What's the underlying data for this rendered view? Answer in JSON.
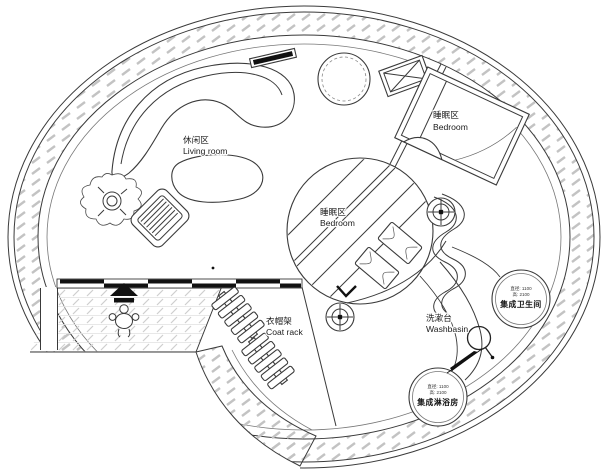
{
  "labels": {
    "living_room": {
      "zh": "休闲区",
      "en": "Living room"
    },
    "bedroom_upper": {
      "zh": "睡眠区",
      "en": "Bedroom"
    },
    "bedroom_center": {
      "zh": "睡眠区",
      "en": "Bedroom"
    },
    "coat_rack": {
      "zh": "衣帽架",
      "en": "Coat rack"
    },
    "washbasin": {
      "zh": "洗漱台",
      "en": "Washbasin"
    }
  },
  "pods": {
    "bathroom": {
      "dims": [
        "直径: 1100",
        "高: 2100"
      ],
      "name": "集成卫生间"
    },
    "shower": {
      "dims": [
        "直径: 1100",
        "高: 2100"
      ],
      "name": "集成淋浴房"
    }
  },
  "symbols": {
    "crosshair": "crosshair-target",
    "plant": "potted-plant",
    "person": "person-entering",
    "entry_arrow": "up-arrow",
    "round_table": "round-table",
    "crossed_box": "crossed-rectangle",
    "drain": "drain-loop",
    "door_wall": "sliding-door-wall"
  },
  "colors": {
    "line": "#3a3a3a",
    "ink": "#111111",
    "bg": "#ffffff",
    "hatch_wall": "#c3c3c3",
    "hatch_floor": "#cfcfcf"
  }
}
